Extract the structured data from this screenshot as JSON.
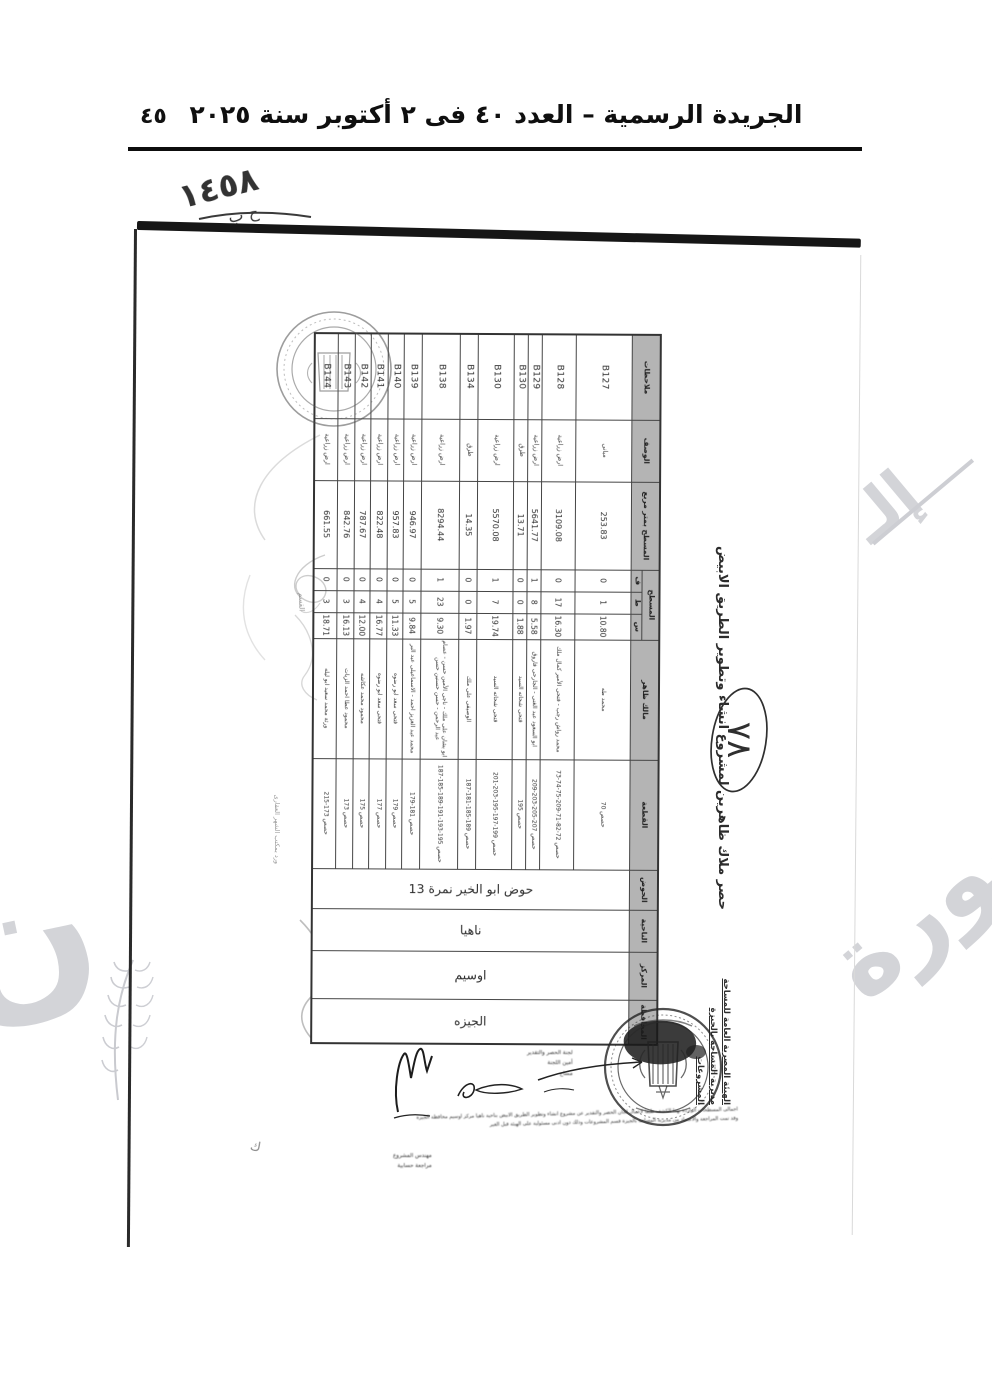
{
  "gazette": {
    "page_number": "٤٥",
    "header_title": "الجريدة الرسمية – العدد ٤٠ فى ٢ أكتوبر سنة ٢٠٢٥"
  },
  "scan": {
    "handwritten_ref": "١٤٥٨",
    "handwritten_ref_sub": "ح ب",
    "circled_number": "٧٨",
    "margin_note": "ورد بمكتب الشهر العقارى",
    "margin_word": "القسم",
    "corner_letter": "ك",
    "title": "حصر ملاك ظاهرين لمشروع انشاء وتطوير الطريق الابيض",
    "issuer": {
      "line1": "الهيئة المصرية العامة للمساحة",
      "line2": "مديرية المساحة بالجيزة",
      "line3": "المشروعات"
    },
    "table": {
      "headers": {
        "governorate": "المحافظة",
        "center": "المركز",
        "district": "الناحية",
        "basin": "الحوض",
        "plot": "القطعة",
        "owner": "مالك ظاهر",
        "area_group": "المسطح",
        "sahm": "س",
        "qirat": "ط",
        "feddan": "ف",
        "area_m2": "المسطح بمتر مربع",
        "description": "الوصف",
        "notes": "ملاحظات"
      },
      "location": {
        "governorate": "الجيزه",
        "center": "اوسيم",
        "district": "ناهيا",
        "basin": "حوض ابو الخير نمرة 13"
      },
      "rows": [
        {
          "code": "B127",
          "desc": "مبانى",
          "area": "253.83",
          "f": "0",
          "k": "1",
          "s": "10.80",
          "owner": "محمد طه",
          "plots": "حصص 70"
        },
        {
          "code": "B128",
          "desc": "ارض زراعية",
          "area": "3109.08",
          "f": "0",
          "k": "17",
          "s": "16.30",
          "owner": "محمد رواش رجب - فتحى الأمير كمال ملك",
          "plots": "حصص 72-82-71-209-75-74-73"
        },
        {
          "code": "B129",
          "desc": "ارض زراعية",
          "area": "5641.77",
          "f": "1",
          "k": "8",
          "s": "5.58",
          "owner": "ابو السعود عبد الغنى - الجارحى فاروق",
          "plots": "حصص 207-205-203-209"
        },
        {
          "code": "B130",
          "desc": "طرق",
          "area": "13.71",
          "f": "0",
          "k": "0",
          "s": "1.88",
          "owner": "فتحى شحاته السيد",
          "plots": "حصص 195"
        },
        {
          "code": "B130",
          "desc": "ارض زراعية",
          "area": "5570.08",
          "f": "1",
          "k": "7",
          "s": "19.74",
          "owner": "فتحى شحاته السيد",
          "plots": "حصص 199-197-195-203-201"
        },
        {
          "code": "B134",
          "desc": "طرق",
          "area": "14.35",
          "f": "0",
          "k": "0",
          "s": "1.97",
          "owner": "الوصيفى على ملك",
          "plots": "حصص 189-185-181-187"
        },
        {
          "code": "B138",
          "desc": "ارض زراعية",
          "area": "8294.44",
          "f": "1",
          "k": "23",
          "s": "9.30",
          "owner": "ابو بشان على ملك - ناجى الأمين حسن - عصام عبد الرحمن - حسن حسنين حسن",
          "plots": "حصص 195-193-191-189-185-187"
        },
        {
          "code": "B139",
          "desc": "ارض زراعية",
          "area": "946.97",
          "f": "0",
          "k": "5",
          "s": "9.84",
          "owner": "محمد عبد العزيز احمد - الاسماعيلى عبد البر",
          "plots": "حصص 181-179"
        },
        {
          "code": "B140",
          "desc": "ارض زراعية",
          "area": "957.83",
          "f": "0",
          "k": "5",
          "s": "11.33",
          "owner": "فتحى سعد ابو رضوه",
          "plots": "حصص 179"
        },
        {
          "code": "B141",
          "desc": "ارض زراعية",
          "area": "822.48",
          "f": "0",
          "k": "4",
          "s": "16.77",
          "owner": "فتحى سعد ابو رضوه",
          "plots": "حصص 177"
        },
        {
          "code": "B142",
          "desc": "ارض زراعية",
          "area": "787.67",
          "f": "0",
          "k": "4",
          "s": "12.00",
          "owner": "محمود محمد عكاشه",
          "plots": "حصص 175"
        },
        {
          "code": "B143",
          "desc": "ارض زراعية",
          "area": "842.76",
          "f": "0",
          "k": "3",
          "s": "16.13",
          "owner": "محمود عطا احمد الزيات",
          "plots": "حصص 173"
        },
        {
          "code": "B144",
          "desc": "ارض زراعية",
          "area": "661.55",
          "f": "0",
          "k": "3",
          "s": "18.71",
          "owner": "ورثة محمد سعيد ابو ليله",
          "plots": "حصص 173-215"
        }
      ]
    },
    "footer": {
      "fine_print_line1": "اجمالى المسطحات الواردة بهذا الكشف طبقا لاعمال لجان الحصر والتقدير عن مشروع انشاء وتطوير الطريق الابيض بناحية ناهيا مركز اوسيم محافظة الجيزه",
      "fine_print_line2": "وقد تمت المراجعة والاعتماد من مديرية المساحة بالجيزة قسم المشروعات وذلك دون ادنى مسئولية على الهيئة قبل الغير",
      "left_labels": [
        "مهندس المشروع",
        "مراجعة حسابية"
      ],
      "stamp_labels": [
        "لجنة الحصر والتقدير",
        "أمين اللجنة",
        "مساح"
      ]
    },
    "watermark": {
      "big_text": "صورة",
      "fragment": "إلـ"
    }
  },
  "colors": {
    "header_fill": "#b4b4b4",
    "ink": "#2b2b2b",
    "rule": "#0d0d0d",
    "watermark": "#d3d4d8"
  }
}
